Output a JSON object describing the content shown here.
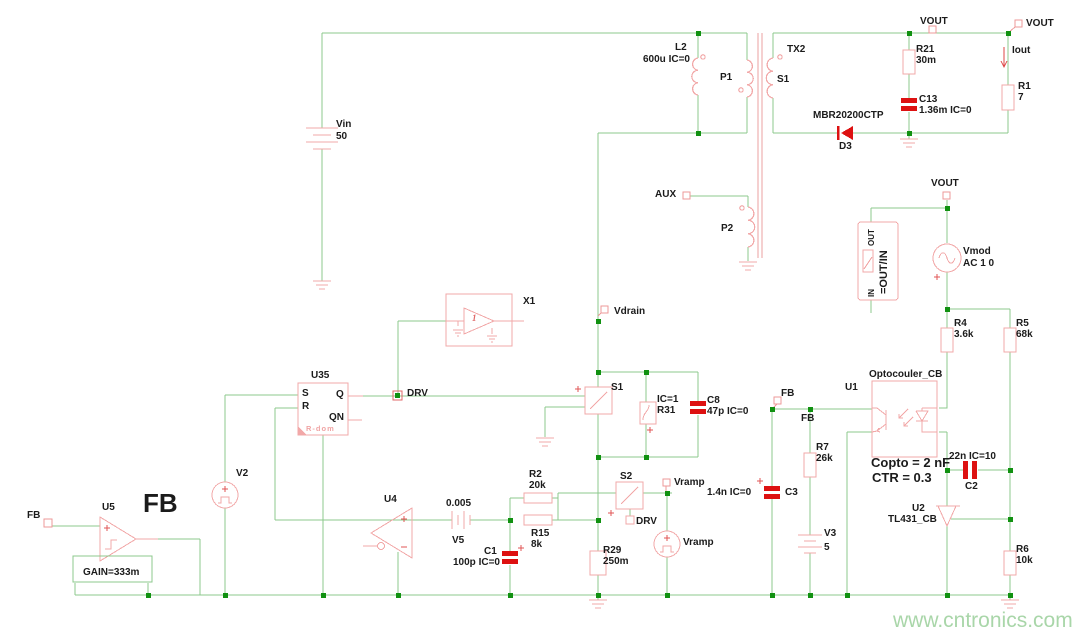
{
  "watermark": "www.cntronics.com",
  "labels": {
    "vin_name": "Vin",
    "vin_value": "50",
    "l2_name": "L2",
    "l2_value": "600u IC=0",
    "p1": "P1",
    "tx2": "TX2",
    "tx_s1": "S1",
    "p2": "P2",
    "aux": "AUX",
    "d3_part": "MBR20200CTP",
    "d3_name": "D3",
    "vout": "VOUT",
    "iout": "Iout",
    "r21_name": "R21",
    "r21_value": "30m",
    "c13_name": "C13",
    "c13_value": "1.36m IC=0",
    "r1_name": "R1",
    "r1_value": "7",
    "ratio": "=OUT/IN",
    "ratio_out": "OUT",
    "ratio_in": "IN",
    "vmod_name": "Vmod",
    "vmod_value": "AC 1 0",
    "r4_name": "R4",
    "r4_value": "3.6k",
    "r5_name": "R5",
    "r5_value": "68k",
    "opto_title": "Optocouler_CB",
    "u1": "U1",
    "fb": "FB",
    "r7_name": "R7",
    "r7_value": "26k",
    "copto": "Copto = 2 nF",
    "ctr": "CTR = 0.3",
    "c2_value": "22n IC=10",
    "c2_name": "C2",
    "c3_value": "1.4n IC=0",
    "c3_name": "C3",
    "v3_name": "V3",
    "v3_value": "5",
    "u2_name": "U2",
    "u2_part": "TL431_CB",
    "r6_name": "R6",
    "r6_value": "10k",
    "vdrain": "Vdrain",
    "x1": "X1",
    "x1_inner": "1",
    "u35": "U35",
    "ff_s": "S",
    "ff_r": "R",
    "ff_q": "Q",
    "ff_qn": "QN",
    "ff_rdom": "R-dom",
    "drv": "DRV",
    "v2": "V2",
    "s1_switch": "S1",
    "s2_switch": "S2",
    "r31_ic": "IC=1",
    "r31_name": "R31",
    "c8_name": "C8",
    "c8_value": "47p IC=0",
    "vramp": "Vramp",
    "u4": "U4",
    "v5_value": "0.005",
    "v5_name": "V5",
    "r2_name": "R2",
    "r2_value": "20k",
    "r15_name": "R15",
    "r15_value": "8k",
    "c1_name": "C1",
    "c1_value": "100p IC=0",
    "r29_name": "R29",
    "r29_value": "250m",
    "u5": "U5",
    "gain": "GAIN=333m",
    "fb_big": "FB"
  }
}
